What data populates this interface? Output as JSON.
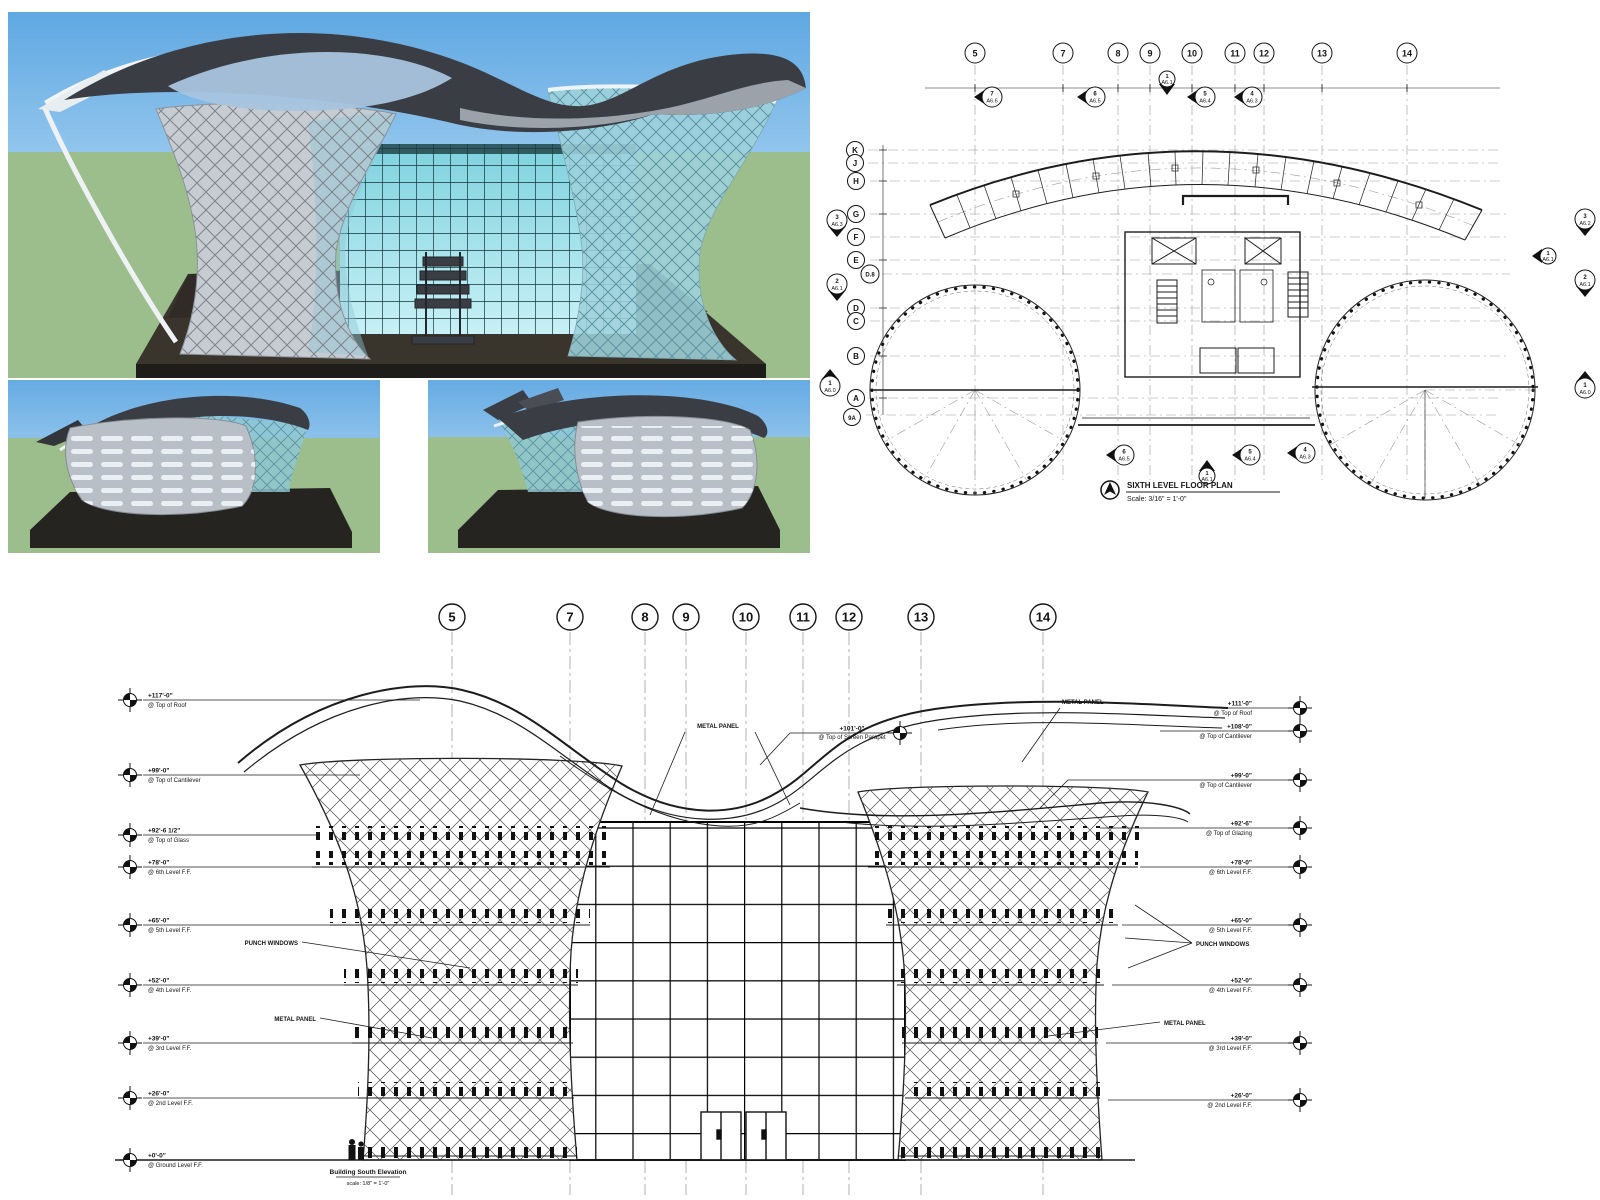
{
  "colors": {
    "sky_top": "#5fa8e2",
    "sky_bottom": "#d9eefb",
    "grass": "#9cbd8c",
    "platform_dark": "#26231f",
    "metal_light": "#c7ccd2",
    "metal_mid": "#9aa1a9",
    "roof_dark": "#3a3e44",
    "glass_cyan": "#8fd0da",
    "glass_blue": "#a9c4de",
    "curtain_cyan": "#7ed2de",
    "line": "#1a1a1a"
  },
  "plan": {
    "title": "SIXTH LEVEL FLOOR PLAN",
    "scale": "Scale: 3/16\" = 1'-0\"",
    "grid_cols": [
      "5",
      "7",
      "8",
      "9",
      "10",
      "11",
      "12",
      "13",
      "14"
    ],
    "grid_rows": [
      "K",
      "J",
      "H",
      "G",
      "F",
      "E",
      "D.8",
      "D",
      "C",
      "B",
      "A",
      "9A"
    ],
    "section_markers": {
      "top": [
        {
          "num": "7",
          "sheet": "A6.6"
        },
        {
          "num": "6",
          "sheet": "A6.5"
        },
        {
          "num": "1",
          "sheet": "A6.1"
        },
        {
          "num": "5",
          "sheet": "A6.4"
        },
        {
          "num": "4",
          "sheet": "A6.3"
        }
      ],
      "left": [
        {
          "num": "3",
          "sheet": "A6.3"
        },
        {
          "num": "2",
          "sheet": "A6.1"
        },
        {
          "num": "1",
          "sheet": "A6.0"
        }
      ],
      "right": [
        {
          "num": "3",
          "sheet": "A6.2"
        },
        {
          "num": "1",
          "sheet": "A6.1"
        },
        {
          "num": "2",
          "sheet": "A6.1"
        },
        {
          "num": "1",
          "sheet": "A6.0"
        }
      ],
      "bottom": [
        {
          "num": "6",
          "sheet": "A6.5"
        },
        {
          "num": "1",
          "sheet": "A6.1"
        },
        {
          "num": "5",
          "sheet": "A6.4"
        },
        {
          "num": "4",
          "sheet": "A6.3"
        }
      ]
    }
  },
  "elevation": {
    "grid_cols": [
      "5",
      "7",
      "8",
      "9",
      "10",
      "11",
      "12",
      "13",
      "14"
    ],
    "levels_left": [
      {
        "value": "+117'-0\"",
        "name": "@ Top of Roof"
      },
      {
        "value": "+99'-0\"",
        "name": "@ Top of Cantilever"
      },
      {
        "value": "+92'-6 1/2\"",
        "name": "@ Top of Glass"
      },
      {
        "value": "+78'-0\"",
        "name": "@ 6th Level F.F."
      },
      {
        "value": "+65'-0\"",
        "name": "@ 5th Level F.F."
      },
      {
        "value": "+52'-0\"",
        "name": "@ 4th Level F.F."
      },
      {
        "value": "+39'-0\"",
        "name": "@ 3rd Level F.F."
      },
      {
        "value": "+26'-0\"",
        "name": "@ 2nd Level F.F."
      },
      {
        "value": "+0'-0\"",
        "name": "@ Ground Level F.F."
      }
    ],
    "levels_right": [
      {
        "value": "+111'-0\"",
        "name": "@ Top of Roof"
      },
      {
        "value": "+108'-0\"",
        "name": "@ Top of Cantilever"
      },
      {
        "value": "+99'-0\"",
        "name": "@ Top of Cantilever"
      },
      {
        "value": "+92'-6\"",
        "name": "@ Top of Glazing"
      },
      {
        "value": "+78'-0\"",
        "name": "@ 6th Level F.F."
      },
      {
        "value": "+65'-0\"",
        "name": "@ 5th Level F.F."
      },
      {
        "value": "+52'-0\"",
        "name": "@ 4th Level F.F."
      },
      {
        "value": "+39'-0\"",
        "name": "@ 3rd Level F.F."
      },
      {
        "value": "+26'-0\"",
        "name": "@ 2nd Level F.F."
      }
    ],
    "parapet": {
      "value": "+101'-0\"",
      "name": "@ Top of Screen Parapet"
    },
    "annotations": {
      "metal_panel": "METAL PANEL",
      "punch_windows": "PUNCH WINDOWS"
    },
    "title": "Building South Elevation",
    "scale": "scale: 1/8\" = 1'-0\""
  }
}
